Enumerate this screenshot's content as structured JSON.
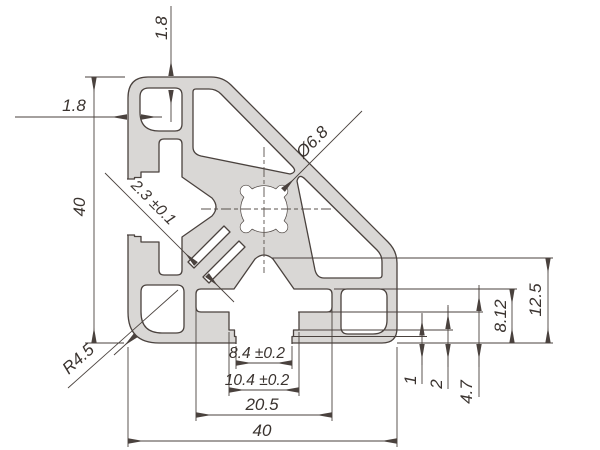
{
  "drawing": {
    "kind": "technical-drawing",
    "subject": "aluminium-extrusion-profile-cross-section",
    "dimensions": {
      "overall_height": "40",
      "overall_width": "40",
      "top_wall": "1.8",
      "side_wall": "1.8",
      "web_thickness": "2.3 ±0.1",
      "center_hole": "Ø6.8",
      "corner_radius": "R4.5",
      "slot_opening": "8.4 ±0.2",
      "slot_throat": "10.4 ±0.2",
      "slot_cavity_width": "20.5",
      "lip_step_1": "1",
      "lip_step_2": "2",
      "lip_height": "4.7",
      "cavity_height": "8.12",
      "side_face_height": "12.5"
    },
    "colors": {
      "profile_fill": "#d9d7d5",
      "outline": "#4a423e",
      "text": "#3a332f",
      "background": "#ffffff"
    }
  }
}
